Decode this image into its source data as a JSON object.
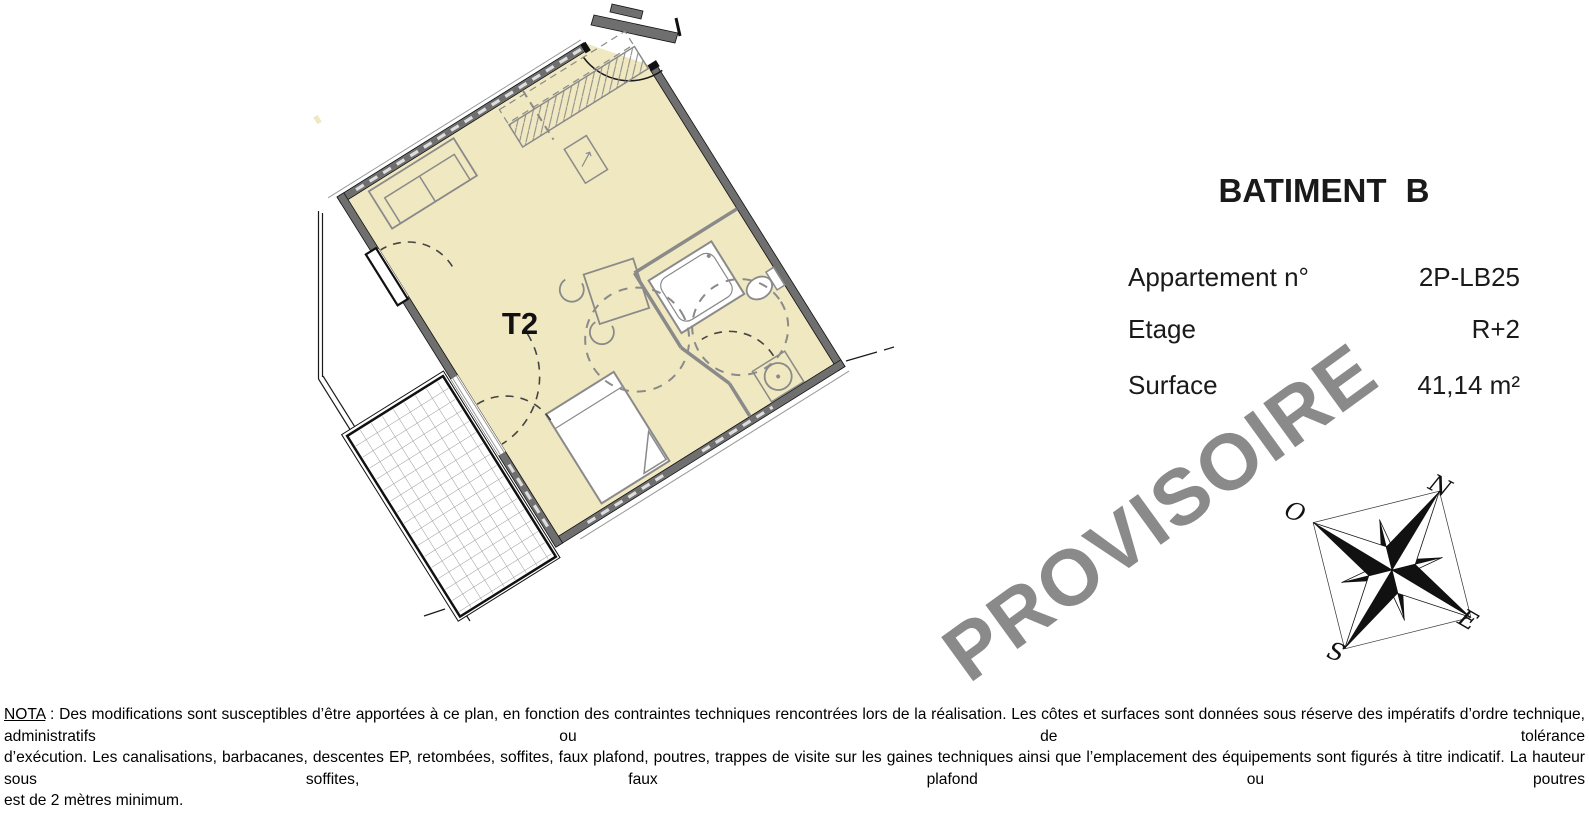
{
  "plan": {
    "unit_label": "T2"
  },
  "watermark": {
    "text": "PROVISOIRE",
    "color": "#8a8a8a",
    "angle_deg": -36
  },
  "info_panel": {
    "title": "BATIMENT B",
    "rows": [
      {
        "label": "Appartement n°",
        "value": "2P-LB25"
      },
      {
        "label": "Etage",
        "value": "R+2"
      },
      {
        "label": "Surface",
        "value": "41,14 m²"
      }
    ]
  },
  "compass": {
    "north_label": "N",
    "west_label": "O",
    "east_label": "E",
    "south_label": "S"
  },
  "nota": {
    "label": "NOTA",
    "line1": " : Des modifications sont susceptibles d’être apportées à ce plan, en fonction des contraintes techniques rencontrées lors de la réalisation. Les côtes et surfaces sont données sous réserve des impératifs d’ordre technique, administratifs ou de tolérance",
    "line2": "d’exécution. Les canalisations, barbacanes, descentes EP, retombées, soffites, faux plafond, poutres, trappes de visite sur les gaines techniques ainsi que l’emplacement des équipements sont figurés à titre indicatif. La hauteur sous soffites, faux plafond ou poutres",
    "line3": "est de 2 mètres minimum."
  },
  "colors": {
    "floor_fill": "#f0e8c0",
    "wall_gray": "#6f6f6f",
    "line_gray": "#8a8a8a",
    "text_black": "#1a1a1a"
  }
}
